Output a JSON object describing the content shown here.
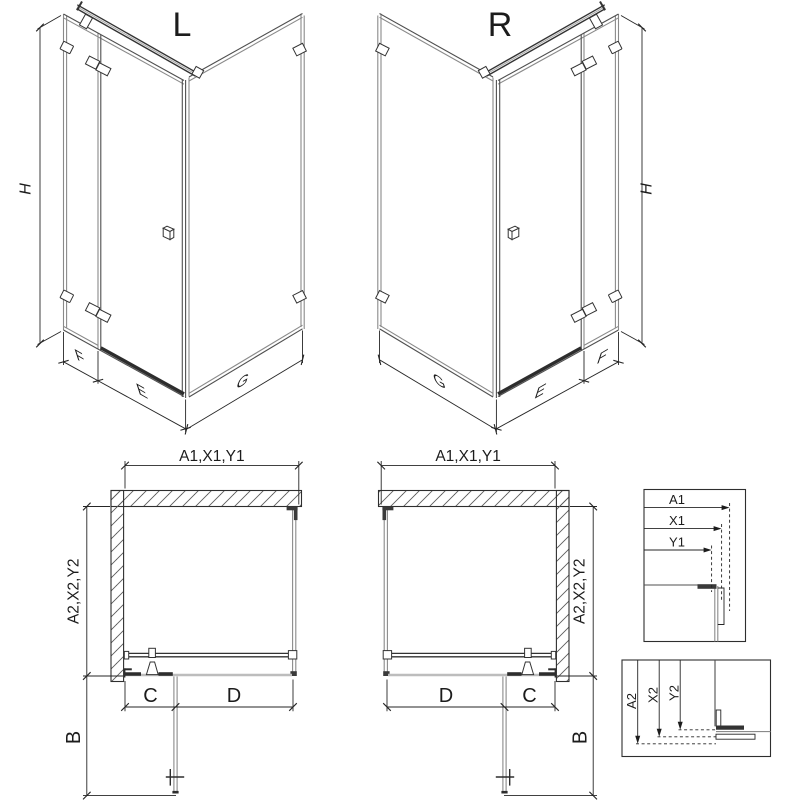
{
  "diagram": {
    "type": "technical-drawing",
    "subject": "corner shower enclosure, left (L) and right (R) variants, isometric and plan views with dimension callouts",
    "iso_left": {
      "title": "L",
      "dim_height": "H",
      "dim_fixed": "F",
      "dim_door": "E",
      "dim_side": "G"
    },
    "iso_right": {
      "title": "R",
      "dim_height": "H",
      "dim_fixed": "F",
      "dim_door": "E",
      "dim_side": "G"
    },
    "plan_left": {
      "dim_width": "A1,X1,Y1",
      "dim_depth": "A2,X2,Y2",
      "dim_c": "C",
      "dim_d": "D",
      "dim_b": "B"
    },
    "plan_right": {
      "dim_width": "A1,X1,Y1",
      "dim_depth": "A2,X2,Y2",
      "dim_c": "C",
      "dim_d": "D",
      "dim_b": "B"
    },
    "detail_width": {
      "labels": [
        "A1",
        "X1",
        "Y1"
      ]
    },
    "detail_depth": {
      "labels": [
        "A2",
        "X2",
        "Y2"
      ]
    },
    "colors": {
      "line": "#262626",
      "glass": "#8a8a8a",
      "sill": "#bdbdbd",
      "hardware_fill": "#ffffff",
      "background": "#ffffff"
    }
  }
}
